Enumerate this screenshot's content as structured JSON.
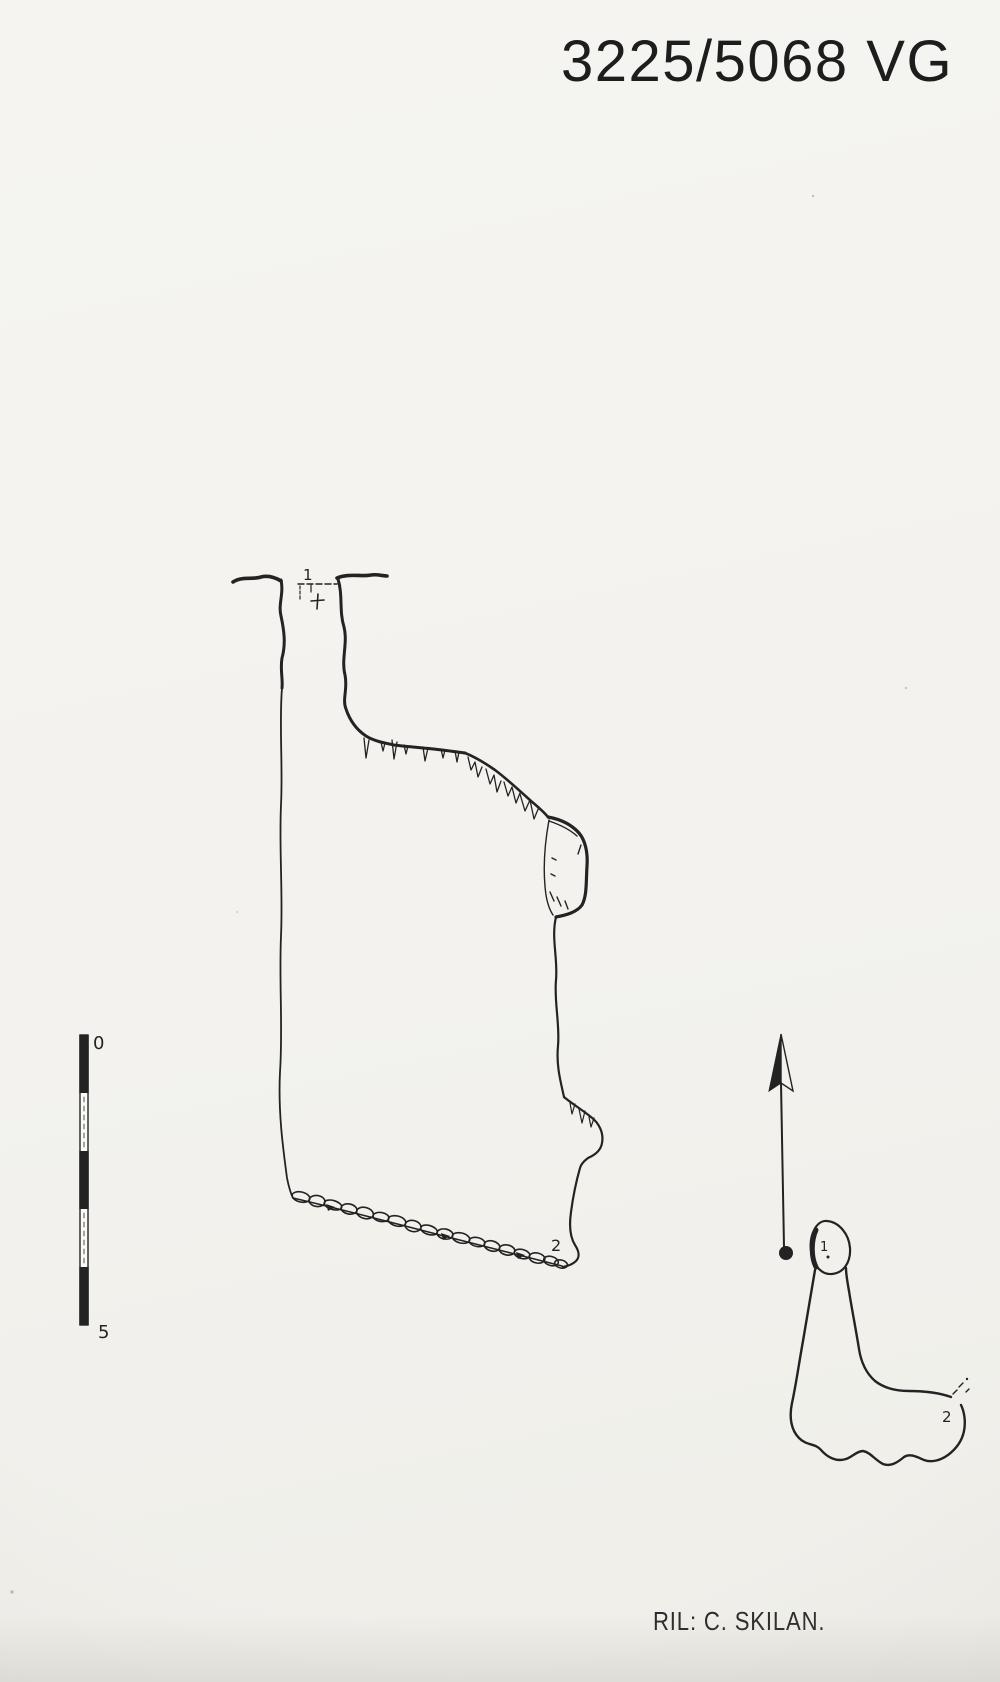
{
  "sheet": {
    "cave_number": "3225/5068 VG",
    "credit": "RIL: C. SKILAN."
  },
  "scale_bar": {
    "start_label": "0",
    "end_label": "5"
  },
  "profile_view": {
    "entrance_station": "1",
    "floor_station": "2"
  },
  "plan_view": {
    "entrance_station": "1",
    "end_station": "2"
  },
  "colors": {
    "paper": "#f3f2ee",
    "ink": "#232323"
  }
}
